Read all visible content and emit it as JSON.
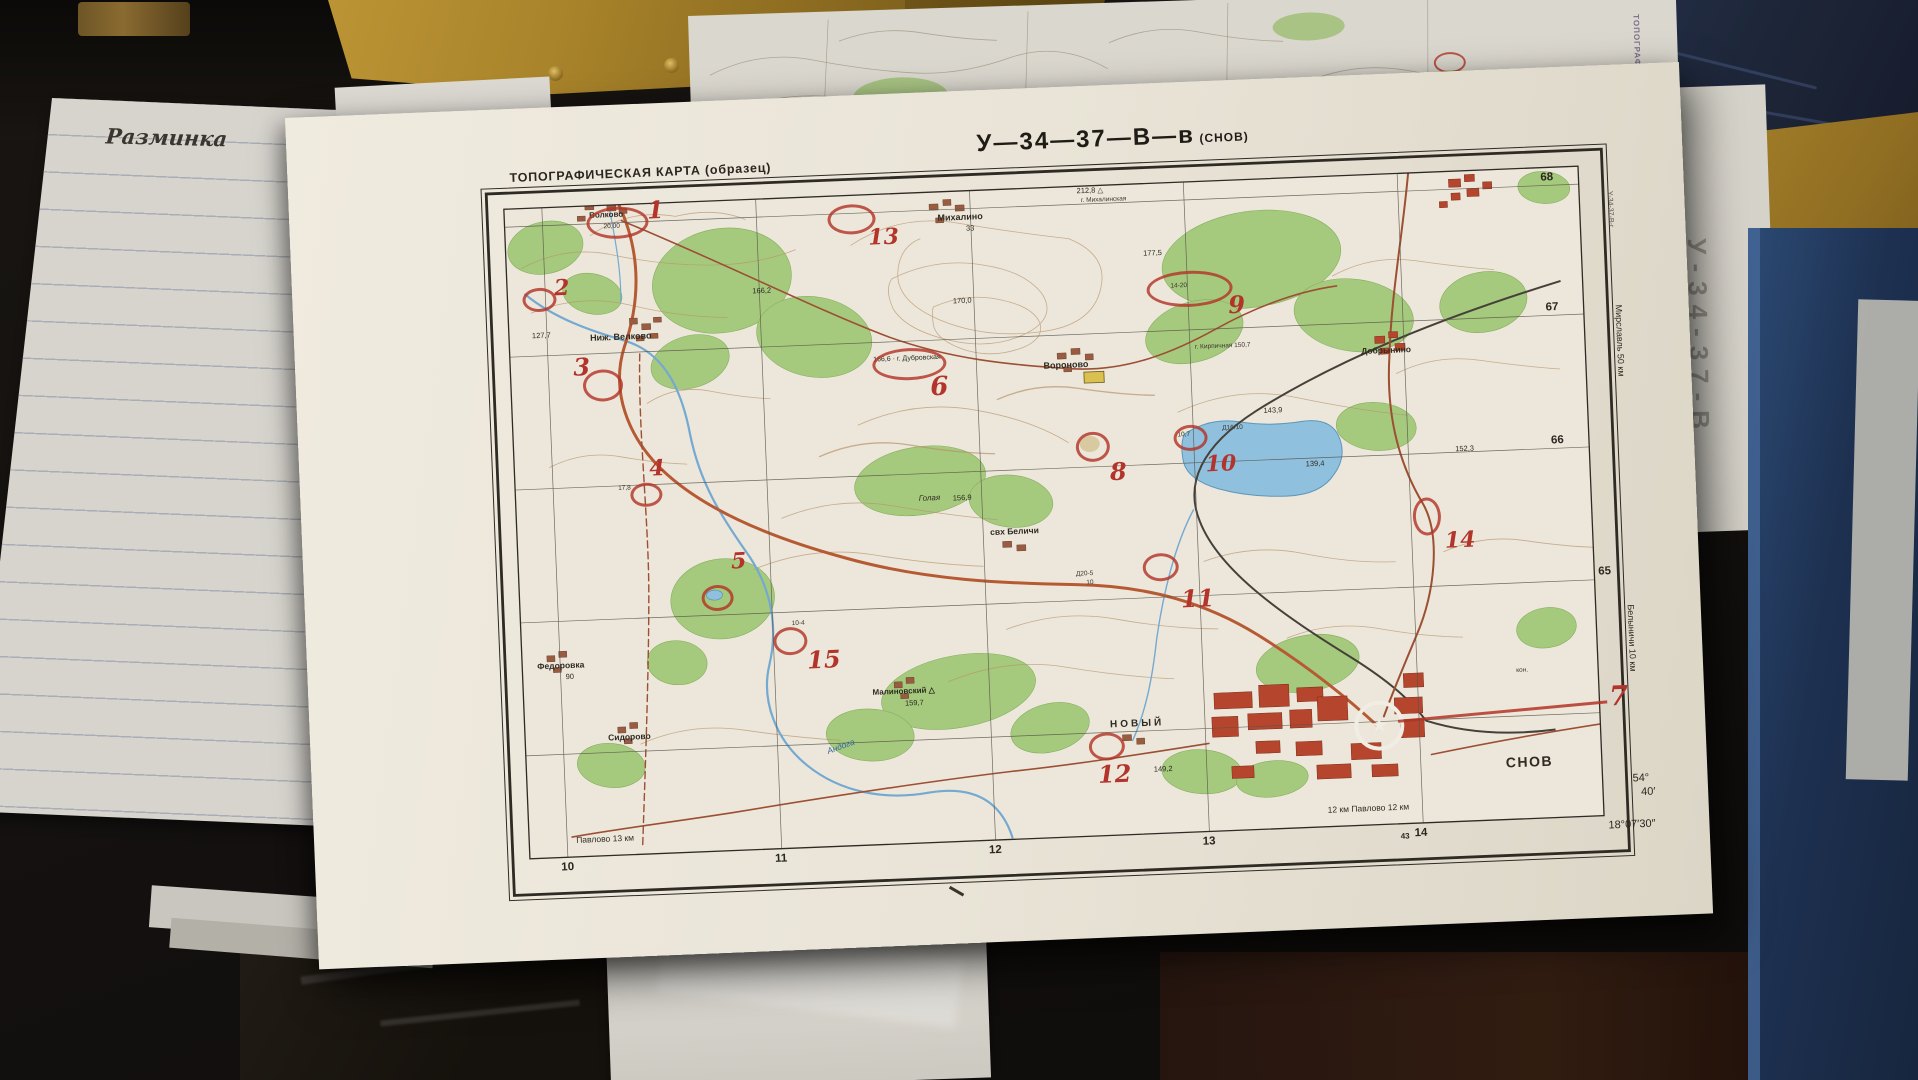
{
  "side_paper": {
    "heading": "Разминка"
  },
  "under_sheet": {
    "vertical_title": "ТОПОГРАФИЧЕСКАЯ КАРТА",
    "ghost_sheet_code": "У-34-37-В"
  },
  "map_sheet": {
    "header": "ТОПОГРАФИЧЕСКАЯ КАРТА (образец)",
    "sheet_code": "У—34—37—В—в",
    "sheet_name": "(СНОВ)",
    "adjacent_sheet_code": "У-34-37-В-г",
    "accent_red": "#b2342a",
    "forest_green": "#a5ca7d",
    "water_blue": "#8fc0dd",
    "town_red": "#b5452c",
    "grid": {
      "bottom": [
        "10",
        "11",
        "12",
        "13",
        "14"
      ],
      "bottom_prefix": "43",
      "right": [
        "68",
        "67",
        "66",
        "65"
      ]
    },
    "corner_coords": {
      "lat_deg": "54°",
      "lat_min": "40′",
      "lon": "18°07′30″"
    },
    "margin_notes": {
      "bottom_left_road": "Павлово 13 км",
      "bottom_right_road": "12 км Павлово 12 км"
    },
    "margin_right": [
      "Мирславль 50 км",
      "Белыничи 10 км"
    ],
    "labels": [
      {
        "t": "Волково",
        "x": 300,
        "y": 106,
        "c": "stl",
        "fs": 8
      },
      {
        "t": "20,00",
        "x": 314,
        "y": 118,
        "c": "t6"
      },
      {
        "t": "127,7",
        "x": 238,
        "y": 224,
        "c": "h"
      },
      {
        "t": "Ниж. Велково",
        "x": 296,
        "y": 228,
        "c": "stl"
      },
      {
        "t": "Михалино",
        "x": 648,
        "y": 122,
        "c": "stl"
      },
      {
        "t": "33",
        "x": 676,
        "y": 134,
        "c": "h"
      },
      {
        "t": "212,8 △",
        "x": 788,
        "y": 101,
        "c": "h"
      },
      {
        "t": "г. Михалинская",
        "x": 792,
        "y": 111,
        "c": "t6"
      },
      {
        "t": "177,5",
        "x": 852,
        "y": 166,
        "c": "h"
      },
      {
        "t": "166,2",
        "x": 460,
        "y": 188,
        "c": "h"
      },
      {
        "t": "170,0",
        "x": 660,
        "y": 206,
        "c": "h"
      },
      {
        "t": "166,6 · г. Дубровская",
        "x": 578,
        "y": 262,
        "c": "h",
        "fs": 7
      },
      {
        "t": "Вороново",
        "x": 748,
        "y": 274,
        "c": "stl"
      },
      {
        "t": "г. Кирпичная 150,7",
        "x": 900,
        "y": 262,
        "c": "t6"
      },
      {
        "t": "Добрынино",
        "x": 1066,
        "y": 272,
        "c": "stl",
        "fs": 8.5
      },
      {
        "t": "143,9",
        "x": 966,
        "y": 328,
        "c": "h"
      },
      {
        "t": "Д16/10",
        "x": 924,
        "y": 344,
        "c": "t6"
      },
      {
        "t": "10,7",
        "x": 879,
        "y": 349,
        "c": "t6"
      },
      {
        "t": "14-20",
        "x": 878,
        "y": 200,
        "c": "t6"
      },
      {
        "t": "139,4",
        "x": 1006,
        "y": 383,
        "c": "h"
      },
      {
        "t": "152,3",
        "x": 1156,
        "y": 374,
        "c": "h"
      },
      {
        "t": "Голая",
        "x": 618,
        "y": 402,
        "c": "hill"
      },
      {
        "t": "156,9",
        "x": 652,
        "y": 403,
        "c": "h"
      },
      {
        "t": "свх Беличи",
        "x": 688,
        "y": 438,
        "c": "stl",
        "fs": 8.5
      },
      {
        "t": "Д20-5",
        "x": 772,
        "y": 484,
        "c": "t6"
      },
      {
        "t": "10",
        "x": 782,
        "y": 493,
        "c": "t6"
      },
      {
        "t": "10-4",
        "x": 486,
        "y": 522,
        "c": "t6"
      },
      {
        "t": "17,8",
        "x": 318,
        "y": 380,
        "c": "t6"
      },
      {
        "t": "Федоровка",
        "x": 230,
        "y": 554,
        "c": "stl",
        "fs": 8.5
      },
      {
        "t": "90",
        "x": 258,
        "y": 566,
        "c": "h"
      },
      {
        "t": "Сидорово",
        "x": 298,
        "y": 628,
        "c": "stl",
        "fs": 8.5
      },
      {
        "t": "Малиновский △",
        "x": 564,
        "y": 594,
        "c": "stl",
        "fs": 8
      },
      {
        "t": "159,7",
        "x": 596,
        "y": 606,
        "c": "h"
      },
      {
        "t": "Андога",
        "x": 516,
        "y": 646,
        "c": "water",
        "r": -18
      },
      {
        "t": "НОВЫЙ",
        "x": 800,
        "y": 634,
        "c": "novy"
      },
      {
        "t": "149,2",
        "x": 842,
        "y": 682,
        "c": "h"
      },
      {
        "t": "кон.",
        "x": 1208,
        "y": 598,
        "c": "t6"
      },
      {
        "t": "СНОВ",
        "x": 1194,
        "y": 686,
        "c": "town"
      }
    ],
    "controls": [
      {
        "n": "1",
        "x": 325,
        "y": 115,
        "rx": 28,
        "ry": 13,
        "nx": 358,
        "ny": 92,
        "fs": 24
      },
      {
        "n": "2",
        "x": 244,
        "y": 189,
        "rx": 14,
        "ry": 9,
        "nx": 262,
        "ny": 168,
        "fs": 22
      },
      {
        "n": "3",
        "x": 304,
        "y": 277,
        "rx": 17,
        "ry": 13,
        "nx": 278,
        "ny": 246,
        "fs": 24
      },
      {
        "n": "4",
        "x": 343,
        "y": 388,
        "rx": 13,
        "ry": 9,
        "nx": 350,
        "ny": 352,
        "fs": 22
      },
      {
        "n": "5",
        "x": 410,
        "y": 494,
        "rx": 13,
        "ry": 10,
        "nx": 428,
        "ny": 448,
        "fs": 22
      },
      {
        "n": "6",
        "x": 611,
        "y": 268,
        "rx": 34,
        "ry": 13,
        "nx": 634,
        "ny": 280,
        "fs": 26
      },
      {
        "n": "7",
        "nx": 1300,
        "ny": 616,
        "fs": 27,
        "line": {
          "x": 1088,
          "y": 646,
          "w": 210,
          "rot": -3
        }
      },
      {
        "n": "8",
        "x": 791,
        "y": 358,
        "rx": 14,
        "ry": 12,
        "nx": 810,
        "ny": 372,
        "fs": 24
      },
      {
        "n": "9",
        "x": 894,
        "y": 204,
        "rx": 40,
        "ry": 15,
        "nx": 935,
        "ny": 210,
        "fs": 24
      },
      {
        "n": "10",
        "x": 889,
        "y": 353,
        "rx": 14,
        "ry": 10,
        "nx": 906,
        "ny": 370,
        "fs": 22
      },
      {
        "n": "11",
        "x": 854,
        "y": 481,
        "rx": 15,
        "ry": 11,
        "nx": 876,
        "ny": 502,
        "fs": 24
      },
      {
        "n": "12",
        "x": 793,
        "y": 658,
        "rx": 15,
        "ry": 11,
        "nx": 786,
        "ny": 674,
        "fs": 24
      },
      {
        "n": "13",
        "x": 559,
        "y": 121,
        "rx": 21,
        "ry": 12,
        "nx": 578,
        "ny": 130,
        "fs": 22
      },
      {
        "n": "14",
        "x": 1122,
        "y": 441,
        "rx": 11,
        "ry": 16,
        "nx": 1142,
        "ny": 456,
        "fs": 22
      },
      {
        "n": "15",
        "x": 481,
        "y": 540,
        "rx": 14,
        "ry": 11,
        "nx": 500,
        "ny": 548,
        "fs": 24
      }
    ]
  }
}
